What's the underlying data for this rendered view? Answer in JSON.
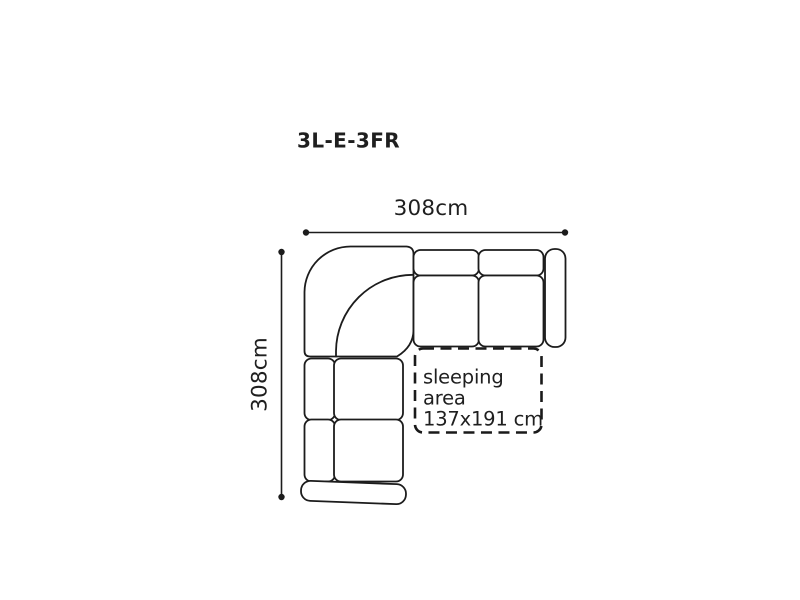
{
  "title": "3L-E-3FR",
  "dimensions": {
    "width_label": "308cm",
    "height_label": "308cm"
  },
  "sleeping_area": {
    "line1": "sleeping",
    "line2": "area",
    "line3": "137x191 cm"
  },
  "colors": {
    "background": "#ffffff",
    "outline": "#1c1c1c",
    "text": "#1f1f1f"
  }
}
